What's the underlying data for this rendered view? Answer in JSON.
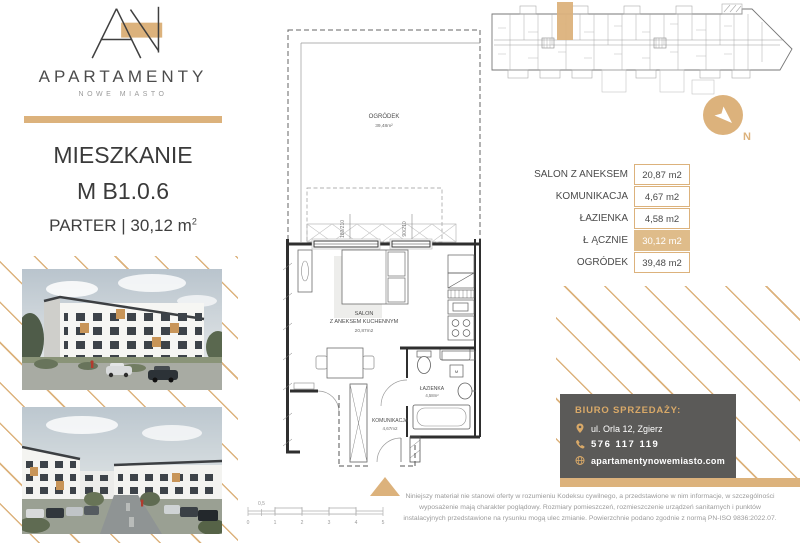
{
  "brand": {
    "name": "APARTAMENTY",
    "subtitle": "NOWE MIASTO"
  },
  "title": {
    "line1": "MIESZKANIE",
    "line2": "M B1.0.6",
    "floor": "PARTER",
    "separator": "|",
    "area": "30,12 m",
    "area_sup": "2"
  },
  "plan": {
    "garden": {
      "name": "OGRÓDEK",
      "area": "39,48m²"
    },
    "salon": {
      "name_line1": "SALON",
      "name_line2": "Z ANEKSEM KUCHENNYM",
      "area": "20,87m2"
    },
    "bathroom": {
      "name": "ŁAZIENKA",
      "area": "4,58m²"
    },
    "hall": {
      "name": "KOMUNIKACJA",
      "area": "4,67m2"
    },
    "window_large": "180/210",
    "window_small": "90/210",
    "washer": "M"
  },
  "scalebar": {
    "zero": "0",
    "half": "0,5",
    "one": "1",
    "two": "2",
    "three": "3",
    "four": "4",
    "five": "5"
  },
  "compass": {
    "north_label": "N"
  },
  "areas_table": {
    "rows": [
      {
        "label": "SALON Z ANEKSEM",
        "value": "20,87 m2"
      },
      {
        "label": "KOMUNIKACJA",
        "value": "4,67 m2"
      },
      {
        "label": "ŁAZIENKA",
        "value": "4,58 m2"
      },
      {
        "label": "Ł ĄCZNIE",
        "value": "30,12 m2"
      },
      {
        "label": "OGRÓDEK",
        "value": "39,48 m2"
      }
    ]
  },
  "sales_office": {
    "heading": "BIURO SPRZEDAŻY:",
    "address": "ul. Orla 12, Zgierz",
    "phone": "576 117 119",
    "website": "apartamentynowemiasto.com"
  },
  "disclaimer": {
    "text": "Niniejszy materiał nie stanowi oferty w rozumieniu Kodeksu cywilnego, a przedstawione w nim informacje, w szczególności wyposażenie mają charakter poglądowy. Rozmiary pomieszczeń, rozmieszczenie urządzeń sanitarnych i punktów instalacyjnych przedstawione na rysunku mogą ulec zmianie. Powierzchnie podano zgodnie z normą PN-ISO 9836:2022.07."
  },
  "colors": {
    "gold": "#DCB27C",
    "gold_icon": "#D9A968",
    "table_highlight": "#DFBC8A",
    "office_panel": "#5B5A58",
    "text_dark": "#3A3A3A",
    "text_gray": "#9B9B9B"
  }
}
